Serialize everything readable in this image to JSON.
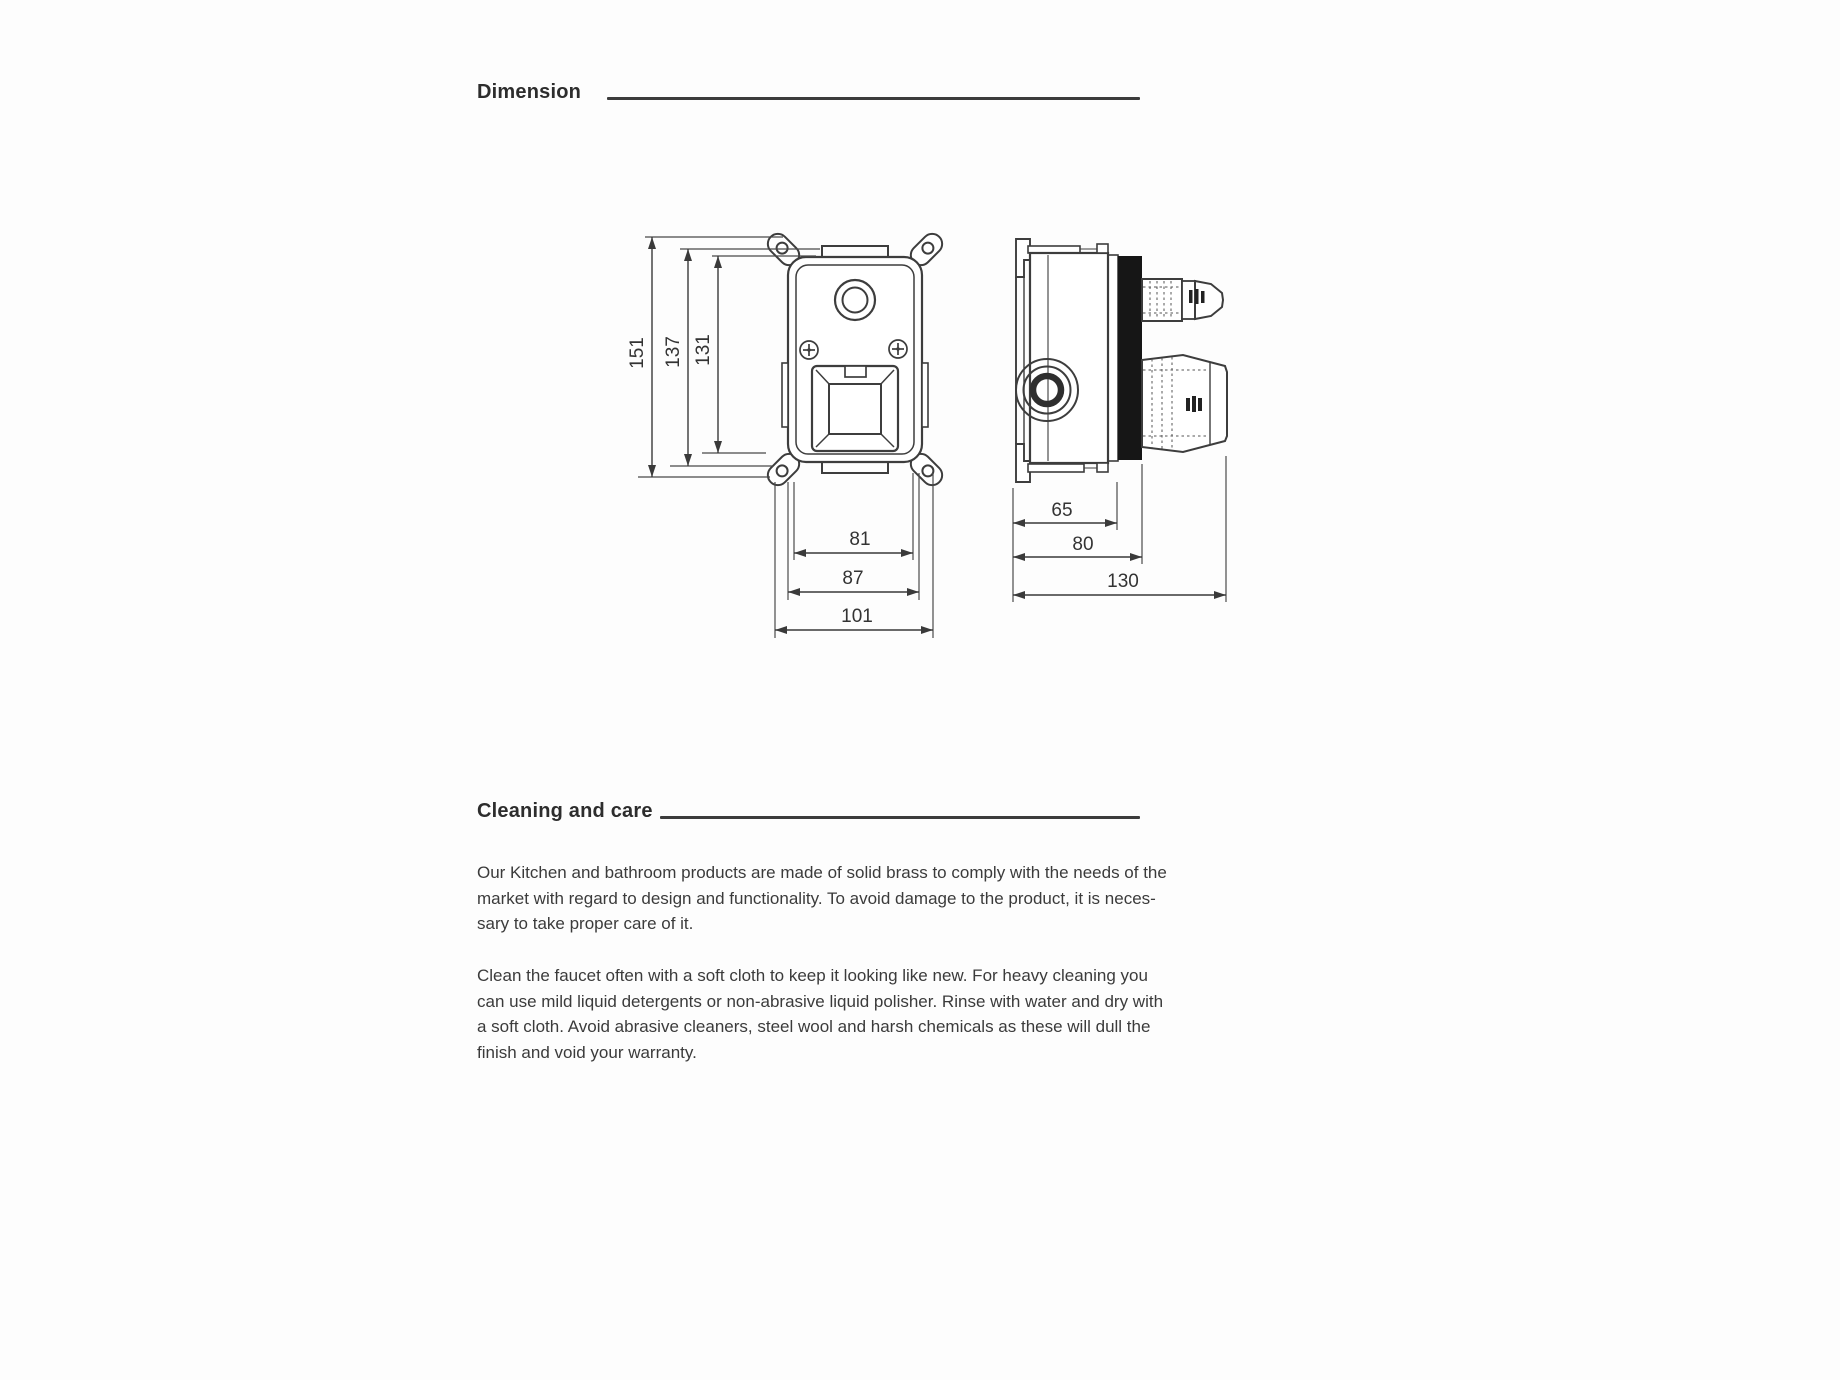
{
  "sections": {
    "dimension": {
      "title": "Dimension"
    },
    "cleaning": {
      "title": "Cleaning and care",
      "para1_lines": [
        "Our Kitchen and bathroom products are made of solid brass to comply with the needs of the",
        "market with regard to design and functionality. To avoid damage to the product, it is neces-",
        "sary to take proper care of it."
      ],
      "para2_lines": [
        "Clean the faucet often with a soft cloth to keep it looking like new. For heavy cleaning you",
        "can use mild liquid detergents or non-abrasive liquid polisher. Rinse with water and dry with",
        "a soft cloth. Avoid abrasive cleaners, steel wool and harsh chemicals as these will dull the",
        "finish and void your warranty."
      ]
    }
  },
  "drawing": {
    "front_view": {
      "dims": {
        "overall_height": "151",
        "body_height": "137",
        "inner_height": "131",
        "inner_width": "81",
        "body_width": "87",
        "overall_width": "101"
      }
    },
    "side_view": {
      "dims": {
        "seal_depth": "65",
        "body_depth": "80",
        "overall_depth": "130"
      }
    },
    "colors": {
      "line": "#3d3d3d",
      "seal_fill": "#161616"
    }
  }
}
